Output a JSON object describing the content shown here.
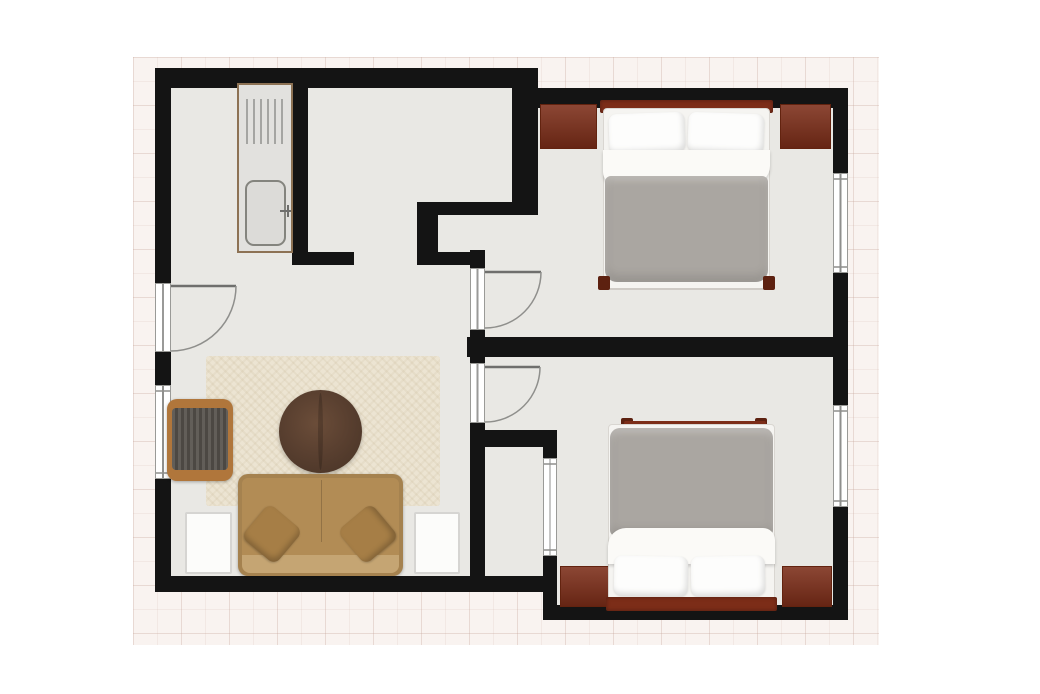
{
  "scene": {
    "kind": "2d-floor-plan-top-view",
    "app_text_visible": false,
    "background": "white page with pale pink tiled ground area around the apartment outline"
  },
  "colors": {
    "page_bg": "#ffffff",
    "ground_tile": "#f9f3f0",
    "ground_grid_line": "#e7d8d3",
    "wall": "#141414",
    "floor": "#e9e8e4",
    "wood_dark_red": "#7c2d18",
    "bed_frame_post": "#5d2110",
    "duvet_gray": "#aaa6a1",
    "linen_white": "#f5f4f1",
    "sofa_tan": "#b28c55",
    "sofa_cushion": "#a67e46",
    "rug_beige": "#ece4d2",
    "coffee_table_brown": "#5a4030",
    "armchair_wood": "#b0763b",
    "armchair_cushion": "#56524c",
    "counter_trim": "#8d7254",
    "window_frame": "#9a9a97"
  },
  "rooms": [
    {
      "id": "living-kitchen-room",
      "label": "open living room with kitchen niche"
    },
    {
      "id": "bedroom-top",
      "label": "bedroom upper right"
    },
    {
      "id": "bedroom-bottom",
      "label": "bedroom lower right"
    },
    {
      "id": "shaft",
      "label": "small enclosed shaft between living room and lower bedroom"
    }
  ],
  "openings": {
    "entry_door": {
      "label": "entry door in left wall, swings into living room"
    },
    "bedroom_top_door": {
      "label": "door from living area into upper bedroom, swings right"
    },
    "bedroom_bottom_door": {
      "label": "door from living area into lower bedroom, swings right"
    },
    "kitchen_passage": {
      "label": "open passage between kitchen niche area and living room"
    },
    "windows": [
      {
        "id": "window-left-wall",
        "label": "window in left wall of living room"
      },
      {
        "id": "window-right-wall-top",
        "label": "window in right wall of upper bedroom"
      },
      {
        "id": "window-right-wall-bottom",
        "label": "window in right wall of lower bedroom"
      },
      {
        "id": "window-shaft-wall",
        "label": "window between shaft and lower bedroom"
      }
    ]
  },
  "furniture": {
    "kitchen_counter": {
      "label": "kitchen counter with drainer and sink"
    },
    "bed_top": {
      "label": "double bed, headboard against top wall, gray duvet, two white pillows"
    },
    "bed_bottom": {
      "label": "double bed, headboard against bottom wall, gray duvet, two white pillows"
    },
    "nightstand_top_left": {
      "label": "dark red-brown dresser left of upper bed"
    },
    "nightstand_top_right": {
      "label": "dark red-brown dresser right of upper bed"
    },
    "nightstand_bottom_left": {
      "label": "dark red-brown dresser left of lower bed"
    },
    "nightstand_bottom_right": {
      "label": "dark red-brown dresser right of lower bed"
    },
    "rug": {
      "label": "large beige textured area rug"
    },
    "coffee_table": {
      "label": "round dark brown coffee table"
    },
    "armchair": {
      "label": "wood-frame armchair with dark gray cushion"
    },
    "sofa": {
      "label": "tan three-seat sofa with two throw cushions"
    },
    "side_table_left": {
      "label": "white side table left of sofa"
    },
    "side_table_right": {
      "label": "white side table right of sofa"
    }
  }
}
